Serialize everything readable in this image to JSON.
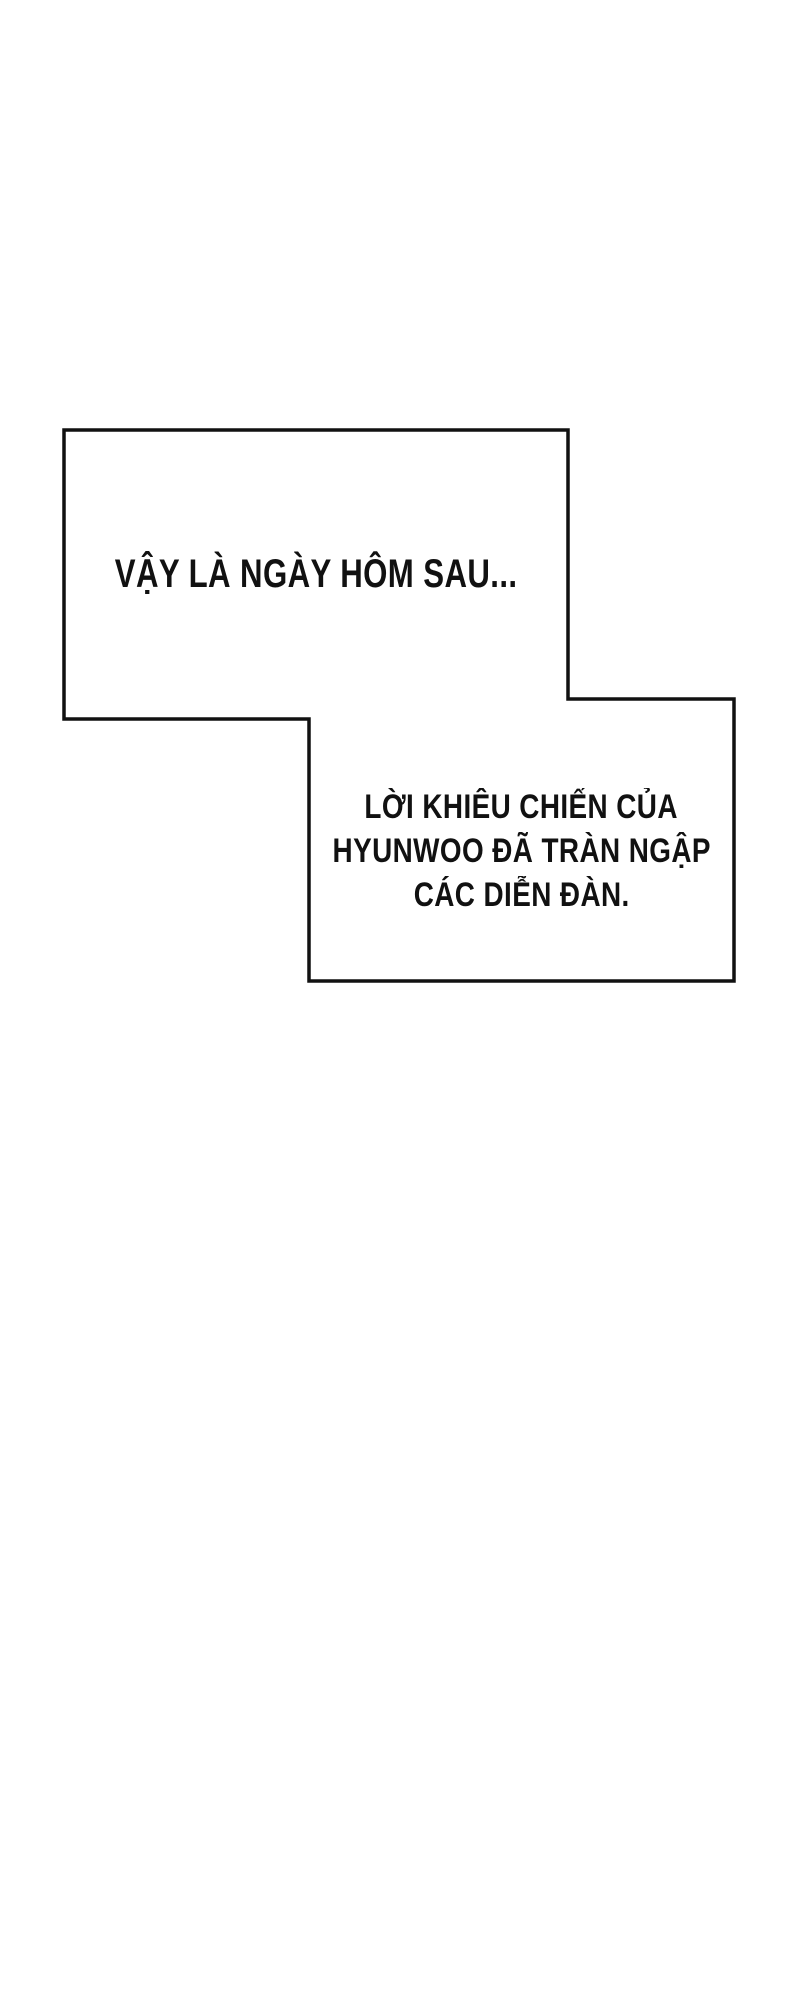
{
  "colors": {
    "ink": "#111111",
    "paper": "#ffffff"
  },
  "narration": {
    "box1": {
      "text": "VẬY LÀ NGÀY HÔM SAU..."
    },
    "box2": {
      "lines": [
        "LỜI KHIÊU CHIẾN CỦA",
        "HYUNWOO ĐÃ TRÀN NGẬP",
        "CÁC DIỄN ĐÀN."
      ]
    }
  }
}
